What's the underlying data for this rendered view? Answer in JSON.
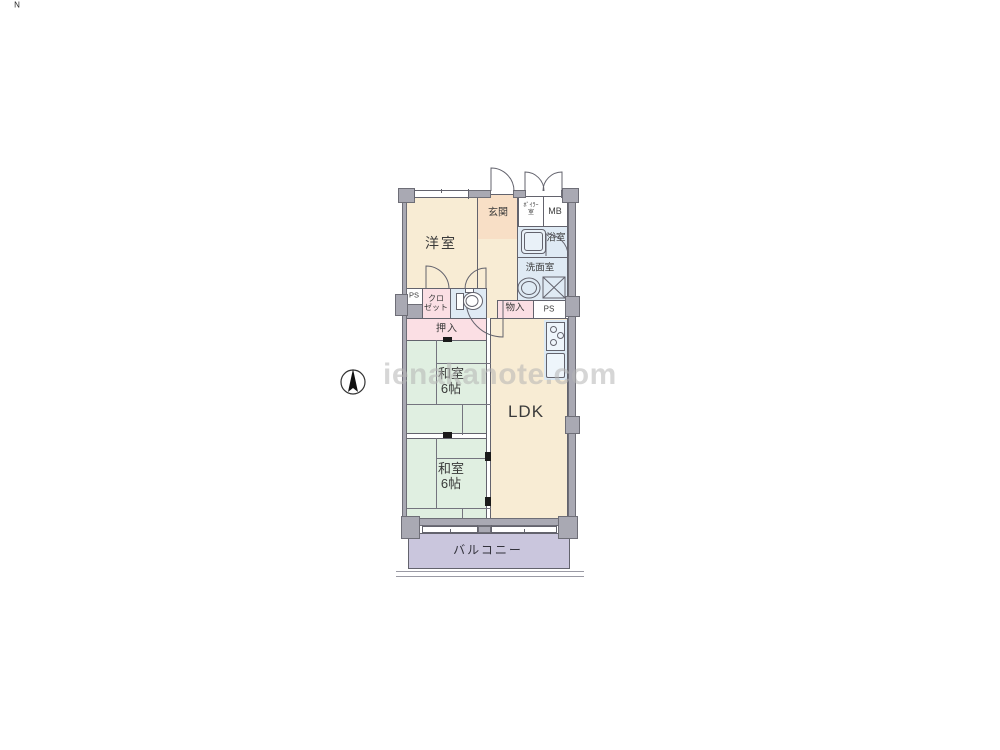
{
  "watermark": {
    "text": "ienakanote.com"
  },
  "compass": {
    "north_label": "N"
  },
  "floorplan": {
    "rooms": {
      "western_room": {
        "label": "洋室"
      },
      "entrance": {
        "label": "玄関"
      },
      "boiler": {
        "label_line1": "ﾎﾞｲﾗｰ",
        "label_line2": "室"
      },
      "meter_box": {
        "label": "MB"
      },
      "bathroom": {
        "label": "浴室"
      },
      "washroom": {
        "label": "洗面室"
      },
      "ps_left": {
        "label": "PS"
      },
      "closet": {
        "label_line1": "クロ",
        "label_line2": "ゼット"
      },
      "storage": {
        "label": "物入"
      },
      "ps_right": {
        "label": "PS"
      },
      "futon_closet": {
        "label": "押入"
      },
      "japanese_rooms": [
        {
          "label": "和室",
          "size": "6帖"
        },
        {
          "label": "和室",
          "size": "6帖"
        }
      ],
      "ldk": {
        "label": "LDK"
      },
      "balcony": {
        "label": "バルコニー"
      }
    },
    "colors": {
      "wall_fill": "#a9a9b3",
      "wall_outline": "#6e6e77",
      "line": "#63636d",
      "western_cream": "#f8ecd4",
      "entrance_peach": "#f8dfc6",
      "tatami_green": "#e0efe1",
      "closet_pink": "#fbdfe4",
      "wet_area_blue": "#dfeaf4",
      "balcony_lavender": "#cac6dd",
      "watermark_gray": "#b5b5b5"
    }
  }
}
